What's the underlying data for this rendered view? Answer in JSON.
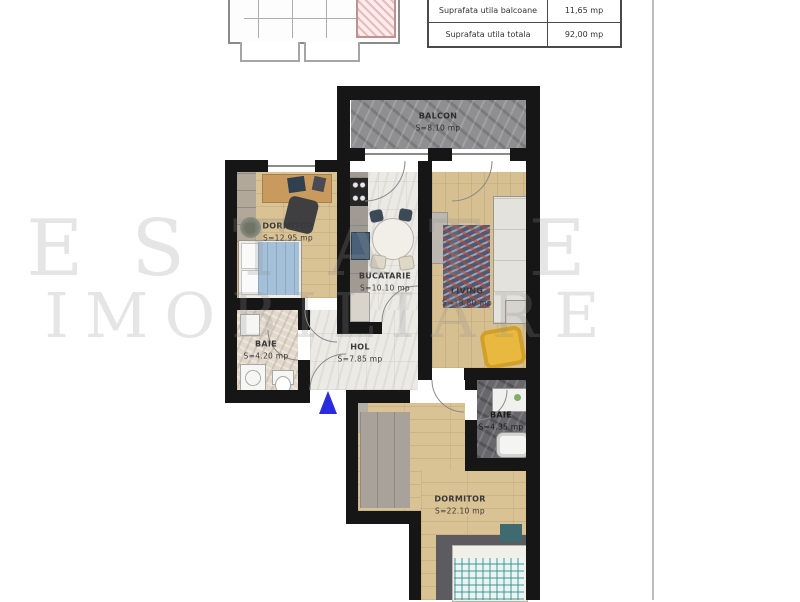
{
  "summary_table": {
    "rows": [
      {
        "label": "Suprafata utila  balcoane",
        "value": "11,65 mp"
      },
      {
        "label": "Suprafata utila totala",
        "value": "92,00 mp"
      }
    ]
  },
  "rooms": {
    "balcon": {
      "name": "BALCON",
      "area": "S=8.10 mp"
    },
    "dormitor1": {
      "name": "DORMITOR",
      "area": "S=12.95 mp"
    },
    "bucatarie": {
      "name": "BUCATARIE",
      "area": "S=10.10 mp"
    },
    "living": {
      "name": "LIVING",
      "area": "S=18.80 mp"
    },
    "baie1": {
      "name": "BAIE",
      "area": "S=4.20 mp"
    },
    "hol": {
      "name": "HOL",
      "area": "S=7.85 mp"
    },
    "baie2": {
      "name": "BAIE",
      "area": "S=4.35 mp"
    },
    "dormitor2": {
      "name": "DORMITOR",
      "area": "S=22.10 mp"
    }
  },
  "watermark": {
    "line1": "ESTATE",
    "line2": "IMOBILIARE"
  },
  "colors": {
    "wall": "#161616",
    "entrance_marker": "#2a2ae0",
    "wood_floor": "#d9c294",
    "balcony_floor": "#8f8f91",
    "highlighted_unit": "#e9bcbc",
    "armchair": "#e8b93e",
    "bed_blanket": "#a4bfd8"
  }
}
